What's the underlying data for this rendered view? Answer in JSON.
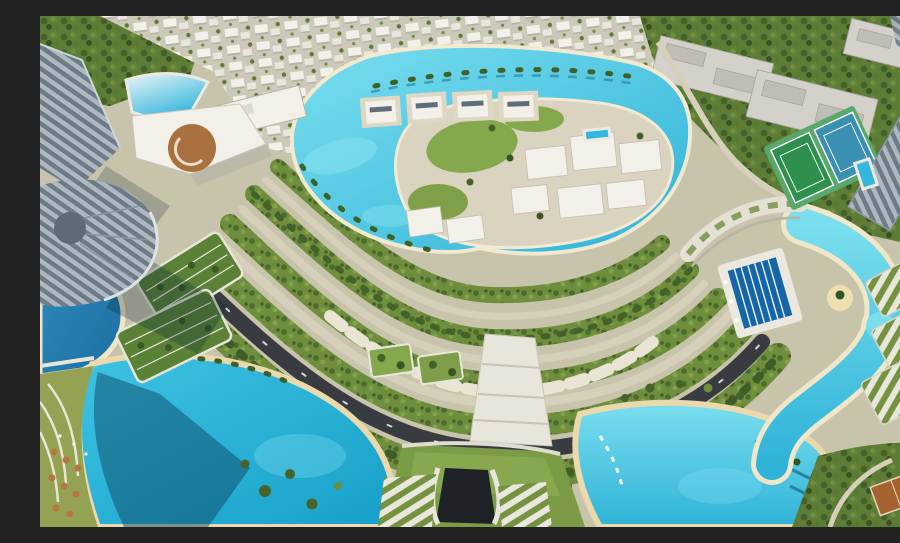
{
  "scene": {
    "title": "Aerial render of a crescent-shaped lagoon resort community",
    "description": "Computer-generated aerial view of a master-planned resort community: a large central turquoise lagoon with an island of white mansions, rows of white villas to the north, a forested campus to the north-east, concentric tree-lined boulevard rings sweeping around the center, a dark curved highway, deep-blue canals and beach lagoons on the left, bottom and right, glass high-rise towers on the left and right edges, tennis courts, a lap pool, terraced green-roof buildings and landscaped gardens.",
    "regions": [
      "villa-district-north",
      "forest-campus-northeast",
      "central-lagoon",
      "lagoon-island-mansions",
      "floating-dock-villas",
      "boulevard-rings",
      "main-highway",
      "central-plaza-steps",
      "left-canal",
      "bottom-left-lagoon",
      "tunnel-mound",
      "bottom-right-lagoon",
      "right-winding-canal",
      "lap-pool",
      "tennis-courts",
      "left-towers",
      "right-tower",
      "clubhouse-with-drum",
      "terraced-green-buildings",
      "corner-garden-terraces"
    ]
  },
  "palette": {
    "groundBase": "#c8c3ab",
    "sand": "#ecdfb0",
    "pathTan": "#d6cfba",
    "roadDark": "#383b3f",
    "villaBase": "#cdc9ba",
    "villaWhite": "#f2f0e8",
    "villaShade": "#b7b3a6",
    "buildingGrey": "#d3d1c9",
    "buildingGreyDark": "#bfbdb4",
    "forestBase": "#5d7c35",
    "greenBand": "#6e8e3d",
    "greenDark": "#44612a",
    "greenLight": "#83a24a",
    "lawn": "#86a84c",
    "moundGreen": "#7b9b46",
    "stripeGreen": "#74923f",
    "stripeWhite": "#e9e7db",
    "towerBandLight": "#aeb8c0",
    "towerBandDark": "#6d7b87",
    "drumBrown": "#a9713e",
    "cabanaBrown": "#b5773f",
    "clayCourt": "#a5622f",
    "courtGreen": "#2f8f4f",
    "courtBlue": "#3b8fb0",
    "courtApron": "#58a86c",
    "poolBlue": "#1565a8",
    "poolCyan": "#35b6dc",
    "lagoonLight": "#7adeee",
    "lagoonMid": "#3fc3e2",
    "lagoonDeep": "#2fb3d8",
    "lagoonDeeper": "#169fc9",
    "canalLight": "#2e8bbf",
    "canalDeep": "#1c6f9f",
    "shadowTeal": "#0e4a66",
    "rimWhite": "#f2ead0",
    "tunnelDark": "#1e2226",
    "white": "#eceae0"
  }
}
